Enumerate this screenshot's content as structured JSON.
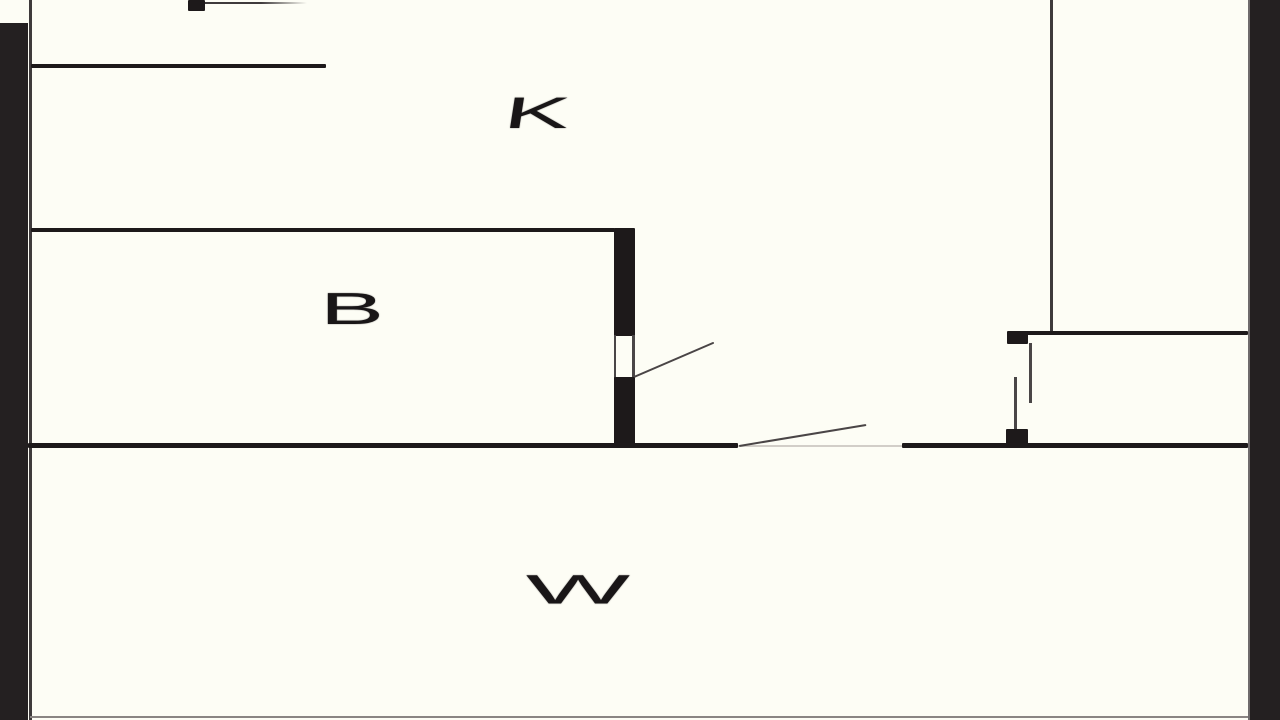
{
  "page": {
    "type": "architectural-floor-plan",
    "description": "Black and white apartment floor plan video frame with letterboxed edges"
  },
  "labels": {
    "room_k": "K",
    "room_b": "B",
    "room_w": "W"
  },
  "colors": {
    "background": "#fdfdf5",
    "wall": "#1d191a",
    "letterbox_bar": "#242021",
    "door_line": "#4a4647",
    "faint_threshold": "#d2cec8"
  }
}
